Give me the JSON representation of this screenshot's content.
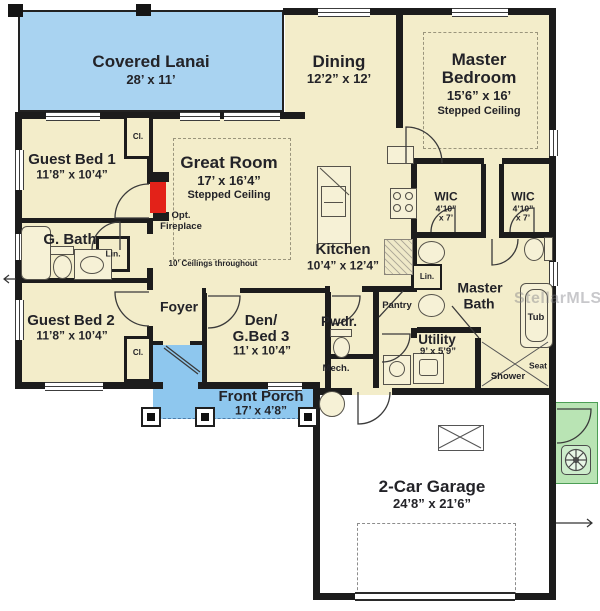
{
  "watermark": "StellarMLS",
  "notes": {
    "ceilings": "10’ Ceilings throughout"
  },
  "rooms": {
    "lanai": {
      "name": "Covered Lanai",
      "dims": "28’ x 11’"
    },
    "dining": {
      "name": "Dining",
      "dims": "12’2” x 12’"
    },
    "master_bedroom": {
      "name1": "Master",
      "name2": "Bedroom",
      "dims": "15’6” x 16’",
      "note": "Stepped Ceiling"
    },
    "guest_bed_1": {
      "name": "Guest Bed 1",
      "dims": "11’8” x 10’4”"
    },
    "great_room": {
      "name": "Great Room",
      "dims": "17’ x 16’4”",
      "note": "Stepped Ceiling"
    },
    "g_bath": {
      "name": "G. Bath"
    },
    "guest_bed_2": {
      "name": "Guest Bed 2",
      "dims": "11’8” x 10’4”"
    },
    "foyer": {
      "name": "Foyer"
    },
    "den": {
      "name1": "Den/",
      "name2": "G.Bed 3",
      "dims": "11’ x 10’4”"
    },
    "front_porch": {
      "name": "Front Porch",
      "dims": "17’ x 4’8”"
    },
    "kitchen": {
      "name": "Kitchen",
      "dims": "10’4” x 12’4”"
    },
    "wic1": {
      "name": "WIC",
      "dims1": "4’10”",
      "dims2": "x 7’"
    },
    "wic2": {
      "name": "WIC",
      "dims1": "4’10”",
      "dims2": "x 7’"
    },
    "master_bath": {
      "name1": "Master",
      "name2": "Bath"
    },
    "pwdr": {
      "name": "Pwdr."
    },
    "pantry": {
      "name": "Pantry"
    },
    "utility": {
      "name": "Utility",
      "dims": "9’ x 5’9”"
    },
    "mech": {
      "name": "Mech."
    },
    "garage": {
      "name": "2-Car Garage",
      "dims": "24’8” x 21’6”"
    }
  },
  "fixtures": {
    "fireplace1": "Opt.",
    "fireplace2": "Fireplace",
    "lin_gbath": "Lin.",
    "lin_master": "Lin.",
    "cl_gb1": "Cl.",
    "cl_gb2": "Cl.",
    "tub": "Tub",
    "seat": "Seat",
    "shower": "Shower"
  },
  "colors": {
    "room_fill": "#f3edca",
    "lanai_blue": "#a9d3f1",
    "porch_blue": "#8ec7ee",
    "garage_fill": "#ffffff",
    "pad_green": "#b9e4b4",
    "wall": "#1c1c1c",
    "fireplace_red": "#e32219"
  }
}
